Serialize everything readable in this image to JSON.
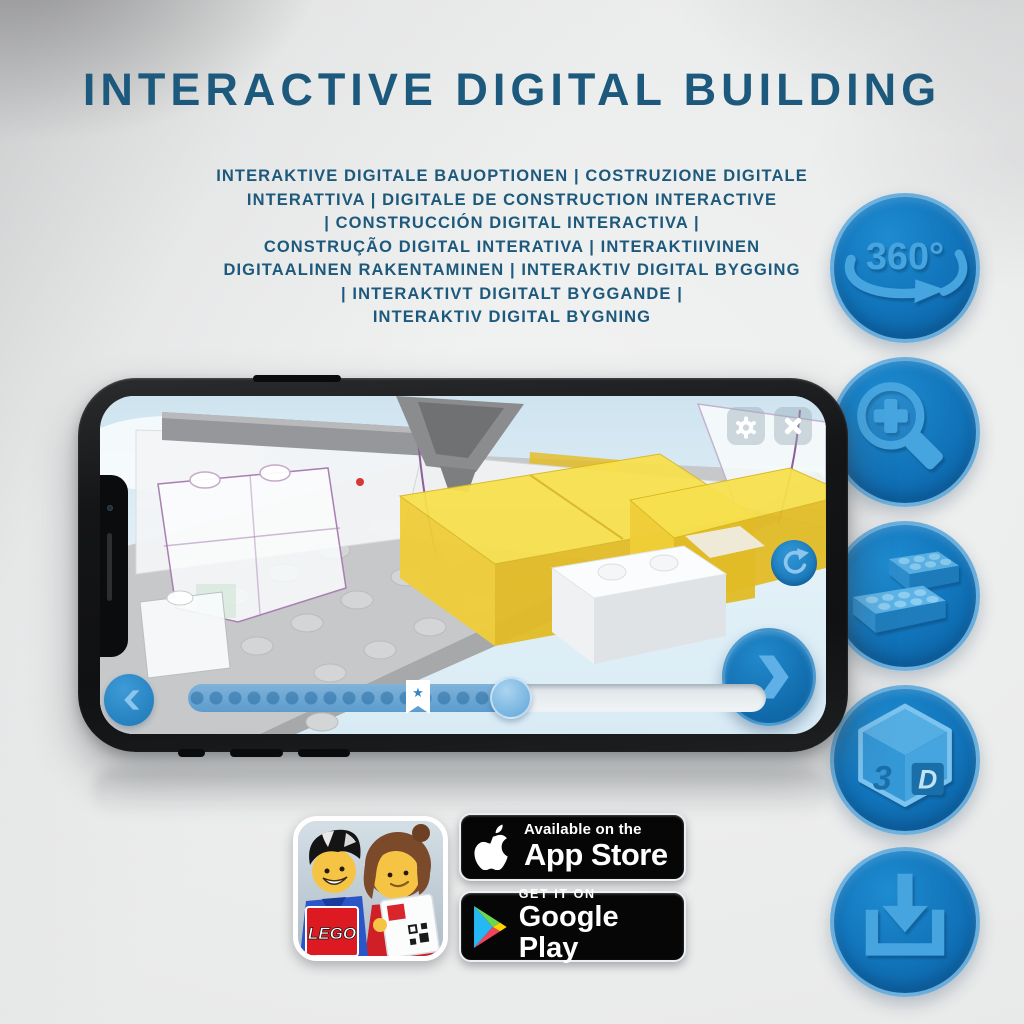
{
  "header": {
    "title": "INTERACTIVE DIGITAL BUILDING",
    "subtitle_lines": [
      "INTERAKTIVE DIGITALE BAUOPTIONEN | COSTRUZIONE DIGITALE",
      "INTERATTIVA | DIGITALE DE CONSTRUCTION INTERACTIVE",
      "| CONSTRUCCIÓN DIGITAL INTERACTIVA |",
      "CONSTRUÇÃO DIGITAL INTERATIVA | INTERAKTIIVINEN",
      "DIGITAALINEN RAKENTAMINEN | INTERAKTIV DIGITAL BYGGING",
      "| INTERAKTIVT DIGITALT BYGGANDE |",
      "INTERAKTIV DIGITAL BYGNING"
    ]
  },
  "features": {
    "icon_names": [
      "360-rotation-icon",
      "zoom-in-icon",
      "lego-bricks-icon",
      "3d-view-icon",
      "download-icon"
    ],
    "rotation_label": "360°",
    "cube_left_label": "3",
    "cube_right_label": "D"
  },
  "phone_app": {
    "progress_percent": 56,
    "bookmark_position_percent": 38,
    "bookmark_glyph": "★"
  },
  "store": {
    "lego_logo_text": "LEGO",
    "app_store_badge": {
      "top_text": "Available on the",
      "bottom_text": "App Store"
    },
    "google_play_badge": {
      "top_text": "GET IT ON",
      "bottom_text": "Google Play"
    }
  },
  "colors": {
    "headline_blue": "#1d597c",
    "icon_circle_blue": "#1173b9",
    "icon_glyph_blue": "#46a4df",
    "app_ui_blue": "#1b82c6",
    "highlight_yellow": "#f2d73f"
  }
}
